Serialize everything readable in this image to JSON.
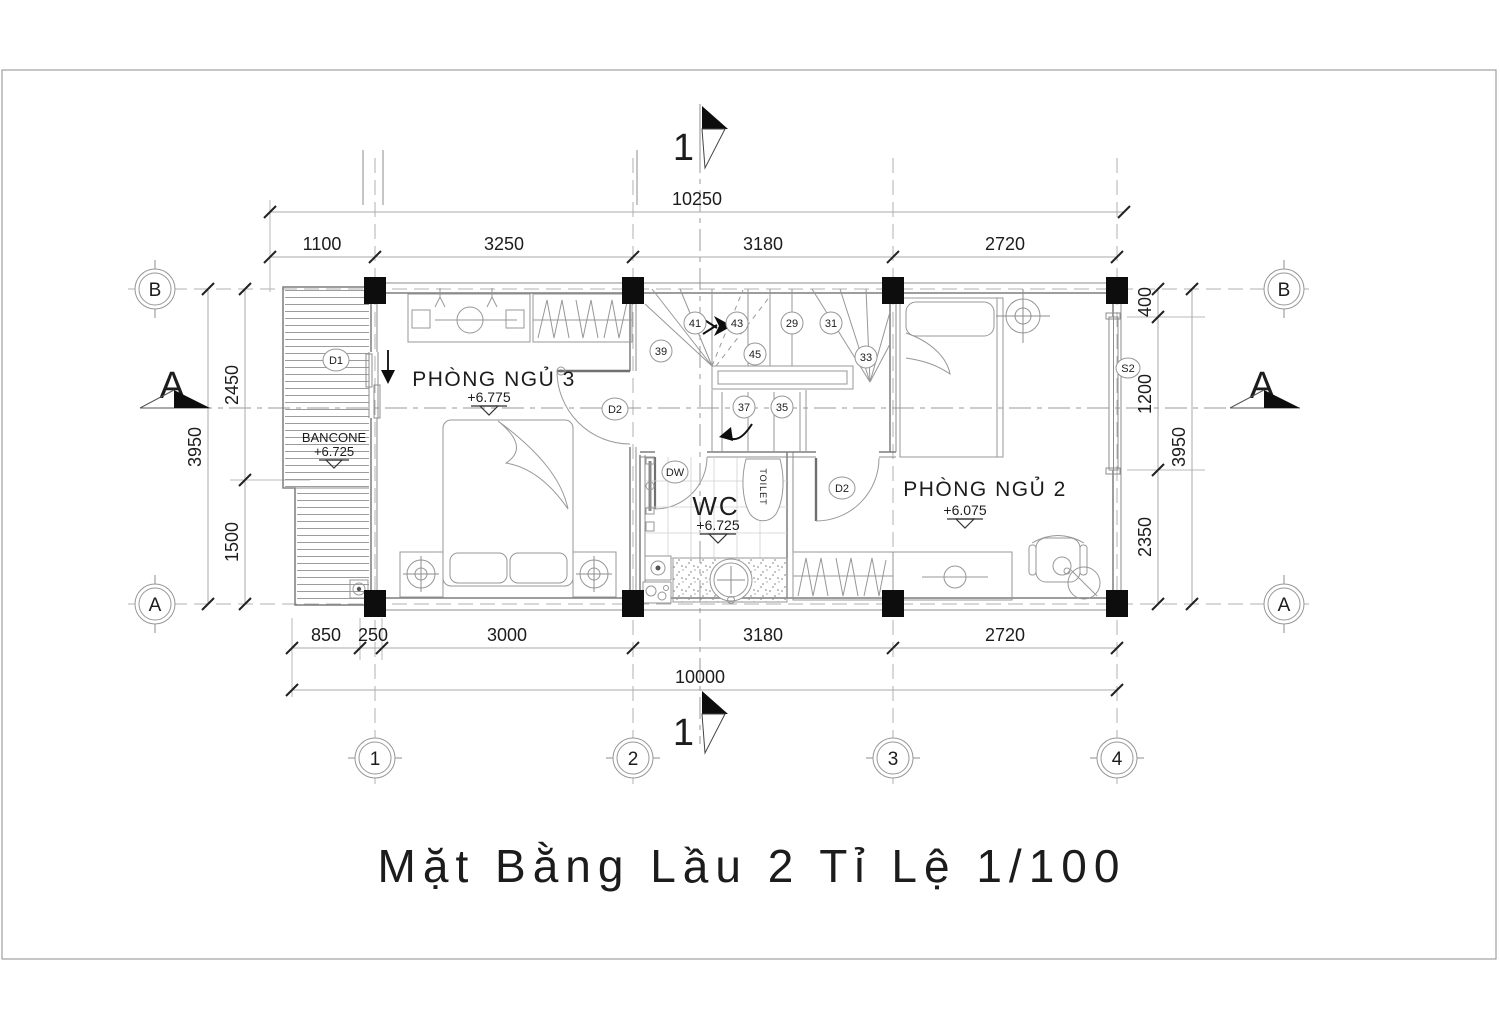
{
  "title": "Mặt Bằng Lầu 2 Tỉ Lệ  1/100",
  "rooms": {
    "bedroom3": {
      "name": "PHÒNG NGỦ 3",
      "level": "+6.775"
    },
    "bedroom2": {
      "name": "PHÒNG NGỦ 2",
      "level": "+6.075"
    },
    "wc": {
      "name": "WC",
      "level": "+6.725",
      "toilet": "TOILET"
    },
    "balcony": {
      "name": "BANCONE",
      "level": "+6.725"
    }
  },
  "tags": {
    "d1": "D1",
    "d2_bedroom3": "D2",
    "d2_bedroom2": "D2",
    "dw": "DW",
    "s2": "S2"
  },
  "stairs": {
    "steps": [
      "39",
      "41",
      "43",
      "29",
      "31",
      "45",
      "33",
      "37",
      "35"
    ]
  },
  "grid_axes": {
    "bottom": [
      "1",
      "2",
      "3",
      "4"
    ],
    "left": [
      "B",
      "A"
    ],
    "right": [
      "B",
      "A"
    ]
  },
  "sections": {
    "a": "A",
    "one": "1"
  },
  "dimensions": {
    "top_overall": "10250",
    "top": [
      "1100",
      "3250",
      "3180",
      "2720"
    ],
    "bottom": [
      "850",
      "250",
      "3000",
      "3180",
      "2720"
    ],
    "bottom_overall": "10000",
    "left": [
      "2450",
      "1500"
    ],
    "left_overall": "3950",
    "right": [
      "400",
      "1200",
      "2350"
    ],
    "right_overall": "3950"
  },
  "colors": {
    "paper": "#ffffff",
    "line": "#8c8c8c",
    "dark": "#1c1c1c",
    "column": "#0d0d0d"
  }
}
